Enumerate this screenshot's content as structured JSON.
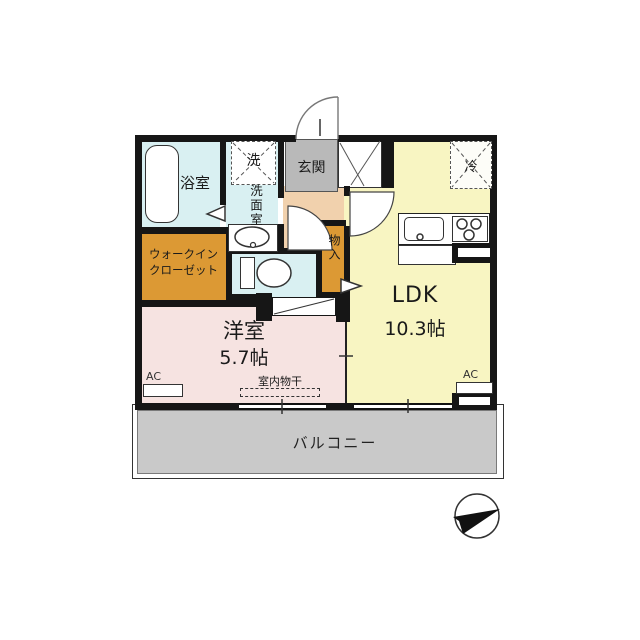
{
  "rooms": {
    "bathroom": "浴室",
    "washer": "洗",
    "washroom": "洗面室",
    "entrance": "玄関",
    "wic_line1": "ウォークイン",
    "wic_line2": "クローゼット",
    "storage": "物入",
    "western_room": "洋室",
    "western_room_size": "5.7帖",
    "ldk": "LDK",
    "ldk_size": "10.3帖",
    "fridge": "冷",
    "balcony": "バルコニー",
    "indoor_drying": "室内物干",
    "ac_left": "AC",
    "ac_right": "AC"
  },
  "icons": {
    "compass": "north-arrow-icon"
  },
  "colors": {
    "wet_area": "#d9f0f2",
    "entrance": "#b9b9b9",
    "hallway": "#f1d1ad",
    "closet": "#dc9934",
    "western_room": "#f6e3e1",
    "ldk": "#f8f5c2",
    "balcony": "#c9c9c9",
    "wall": "#161616"
  }
}
